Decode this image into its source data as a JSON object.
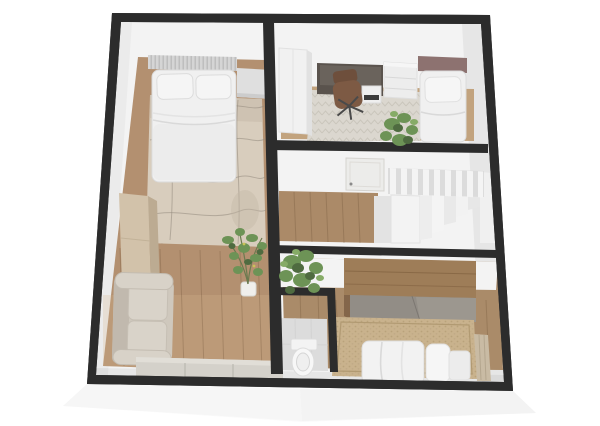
{
  "app": {
    "title": "3D floor plan render",
    "view": "top-down 3d dollhouse"
  },
  "palette": {
    "wall_dark": "#2c2c2c",
    "wall_face": "#f3f3f3",
    "base_white": "#fafafa",
    "wood_main": "#b39070",
    "wood_office": "#c2a37e",
    "wood_hall": "#ab8a68",
    "wood_bedroom": "#aa8b69",
    "marble": "#d8cdbd",
    "marble_vein": "#948a7d",
    "carpet": "#dbd7cf",
    "jute": "#c9b28d",
    "tile_wc": "#dcdcdc",
    "sofa": "#cfc8bd",
    "sofa_cushion": "#d9d3c9",
    "cabinet_beige": "#d2c2aa",
    "sideboard": "#d4d1ca",
    "dresser_gray": "#dfdfdf",
    "desk_dark": "#5a534d",
    "chair_brown": "#7d5a44",
    "headboard_gray": "#d5d5d5",
    "headboard_mauve": "#8d7270",
    "bed_white": "#f0f0f0",
    "wardrobe_white": "#f1f1f1",
    "wardrobe_wood": "#9e7d58",
    "wardrobe_door": "#928d86",
    "curtain": "#c9bba4",
    "plant_green": "#6d9356",
    "plant_dark": "#4f6b40",
    "plant_light": "#86ab67",
    "stair_white": "#f3f3f3",
    "stair_shadow": "#d9d9d9",
    "door_panel": "#ececea"
  },
  "scene": {
    "rooms": [
      {
        "name": "bedroom-living-studio",
        "furniture": [
          "double-bed",
          "marble-rug",
          "dresser",
          "tall-cabinet",
          "sofa",
          "sideboard",
          "potted-plant"
        ]
      },
      {
        "name": "office-guest-room",
        "furniture": [
          "white-wardrobe",
          "desk",
          "office-chair",
          "drawer-unit",
          "single-bed",
          "plant"
        ]
      },
      {
        "name": "hallway-stairs",
        "furniture": [
          "door",
          "staircase",
          "railing"
        ]
      },
      {
        "name": "wc",
        "furniture": [
          "toilet"
        ]
      },
      {
        "name": "bedroom-2",
        "furniture": [
          "wood-wardrobe",
          "jute-rug",
          "double-bed",
          "curtain-panel",
          "plant"
        ]
      }
    ]
  }
}
